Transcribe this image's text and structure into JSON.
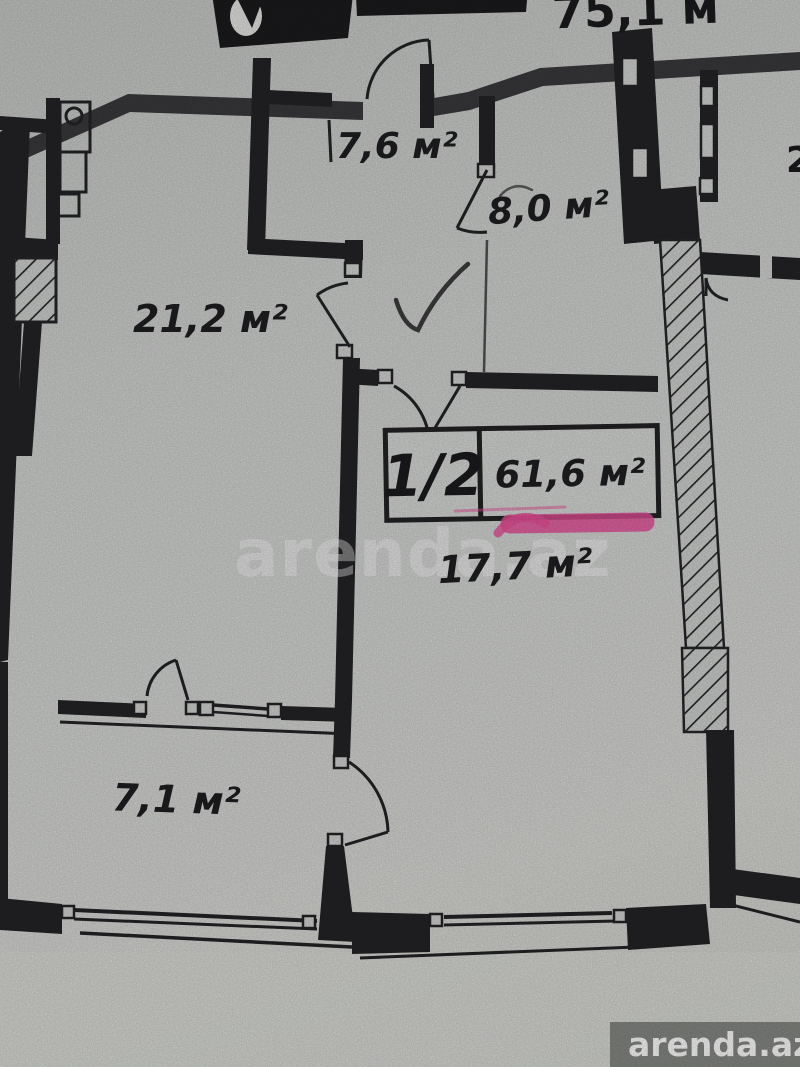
{
  "plan": {
    "top_area_label": "75,1 м",
    "edge_partial_digit": "2",
    "unit_info": {
      "floors": "1/2",
      "total_area": "61,6 м²"
    },
    "rooms": {
      "hall": "7,6 м²",
      "room8": "8,0 м²",
      "living": "21,2 м²",
      "main": "17,7 м²",
      "kitchen": "7,1 м²"
    }
  },
  "branding": {
    "watermark": "arenda.az",
    "badge": "arenda.az"
  },
  "colors": {
    "paper": "#d3d5d3",
    "ink": "#242427",
    "highlight": "#e8509a",
    "watermark": "#ffffff",
    "badge_bg": "#6f726e"
  }
}
